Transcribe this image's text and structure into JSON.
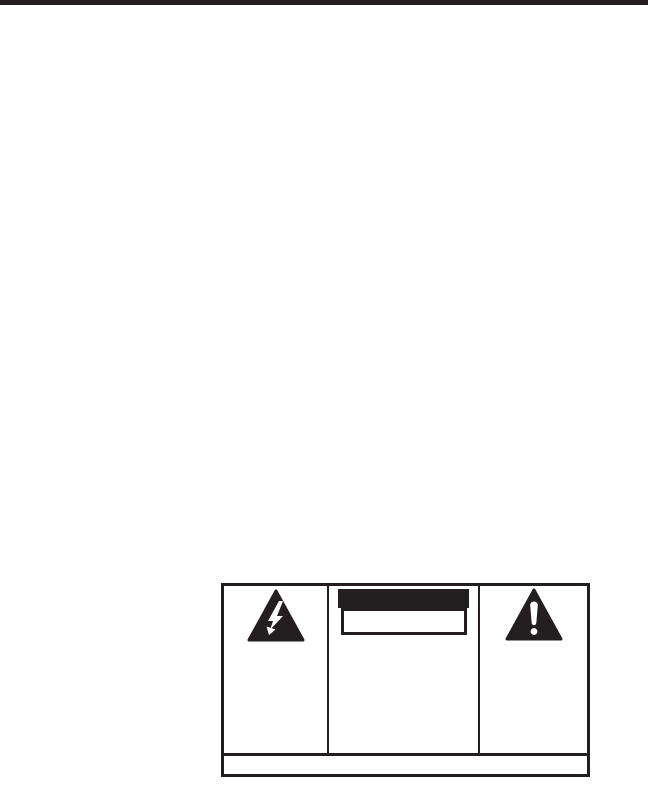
{
  "page": {
    "kind": "manual-safety-page",
    "background_color": "#ffffff",
    "ink_color": "#231f20",
    "top_rule": {
      "height_px": 5,
      "full_width": true
    }
  },
  "warning_box": {
    "left_cell": {
      "icon": "high-voltage-lightning-triangle-icon",
      "text": ""
    },
    "center_cell": {
      "caution_bar_text": "",
      "inner_box_text": ""
    },
    "right_cell": {
      "icon": "alert-exclamation-triangle-icon",
      "text": ""
    },
    "footer_text": ""
  }
}
